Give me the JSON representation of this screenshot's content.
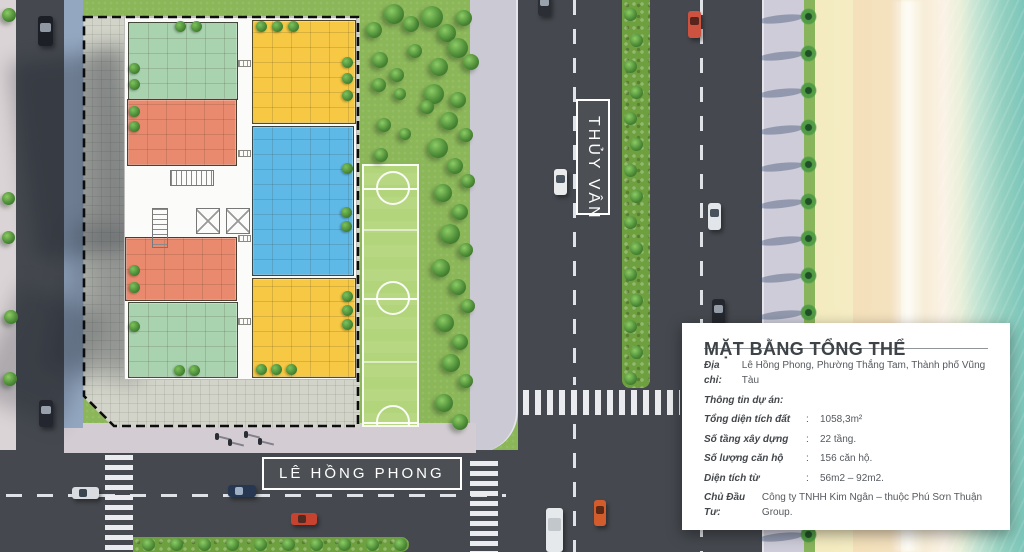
{
  "road_labels": {
    "vertical": "THỦY VÂN",
    "horizontal": "LÊ HỒNG PHONG"
  },
  "info_panel": {
    "title": "MẶT BẰNG TỔNG THỂ",
    "address_label": "Địa chỉ:",
    "address_value": "Lê Hồng Phong, Phường Thắng Tam, Thành phố Vũng Tàu",
    "section_heading": "Thông tin dự án:",
    "colon": ":",
    "rows": [
      {
        "label": "Tổng diện tích đất",
        "value": "1058,3m²"
      },
      {
        "label": "Số tầng xây dựng",
        "value": "22 tầng."
      },
      {
        "label": "Số lượng căn hộ",
        "value": "156 căn hộ."
      },
      {
        "label": "Diện tích từ",
        "value": "56m2 – 92m2."
      }
    ],
    "developer_label": "Chủ Đầu Tư:",
    "developer_value": "Công ty TNHH Kim Ngân – thuộc Phú Sơn Thuận Group."
  },
  "legend_colors": {
    "unit_green": "#a9d2ae",
    "unit_yellow": "#f6c844",
    "unit_orange": "#e98a6e",
    "unit_blue": "#5fb9e6",
    "road": "#45494f",
    "sand": "#f4ebbf",
    "sea": "#7cc6ba"
  },
  "plan": {
    "units": [
      {
        "name": "green-top-left",
        "x": 128,
        "y": 22,
        "w": 110,
        "h": 78,
        "color": "green"
      },
      {
        "name": "yellow-top-right",
        "x": 252,
        "y": 20,
        "w": 104,
        "h": 104,
        "color": "yellow"
      },
      {
        "name": "orange-upper-left",
        "x": 127,
        "y": 99,
        "w": 110,
        "h": 67,
        "color": "orange"
      },
      {
        "name": "blue-right",
        "x": 252,
        "y": 126,
        "w": 102,
        "h": 150,
        "color": "blue"
      },
      {
        "name": "orange-lower-left",
        "x": 125,
        "y": 237,
        "w": 112,
        "h": 64,
        "color": "orange"
      },
      {
        "name": "yellow-bottom-right",
        "x": 252,
        "y": 278,
        "w": 104,
        "h": 100,
        "color": "yellow"
      },
      {
        "name": "green-bottom-left",
        "x": 128,
        "y": 302,
        "w": 110,
        "h": 76,
        "color": "green"
      }
    ],
    "trees": [
      [
        180,
        26
      ],
      [
        196,
        26
      ],
      [
        134,
        68
      ],
      [
        134,
        84
      ],
      [
        261,
        26
      ],
      [
        277,
        26
      ],
      [
        293,
        26
      ],
      [
        347,
        62
      ],
      [
        347,
        78
      ],
      [
        347,
        95
      ],
      [
        134,
        111
      ],
      [
        134,
        126
      ],
      [
        347,
        168
      ],
      [
        346,
        212
      ],
      [
        346,
        226
      ],
      [
        134,
        270
      ],
      [
        134,
        287
      ],
      [
        134,
        326
      ],
      [
        179,
        370
      ],
      [
        194,
        370
      ],
      [
        261,
        369
      ],
      [
        276,
        369
      ],
      [
        291,
        369
      ],
      [
        347,
        296
      ],
      [
        347,
        310
      ],
      [
        347,
        324
      ]
    ],
    "hatches": [
      [
        238,
        60,
        13,
        7
      ],
      [
        238,
        150,
        13,
        7
      ],
      [
        238,
        235,
        13,
        7
      ],
      [
        238,
        318,
        13,
        7
      ]
    ]
  },
  "scenery": {
    "grass_trees": [
      [
        366,
        22,
        16
      ],
      [
        384,
        4,
        20
      ],
      [
        403,
        16,
        16
      ],
      [
        421,
        6,
        22
      ],
      [
        438,
        24,
        18
      ],
      [
        456,
        10,
        16
      ],
      [
        448,
        38,
        20
      ],
      [
        463,
        54,
        16
      ],
      [
        430,
        58,
        18
      ],
      [
        408,
        44,
        14
      ],
      [
        372,
        52,
        16
      ],
      [
        390,
        68,
        14
      ],
      [
        424,
        84,
        20
      ],
      [
        450,
        92,
        16
      ],
      [
        440,
        112,
        18
      ],
      [
        459,
        128,
        14
      ],
      [
        428,
        138,
        20
      ],
      [
        447,
        158,
        16
      ],
      [
        461,
        174,
        14
      ],
      [
        434,
        184,
        18
      ],
      [
        452,
        204,
        16
      ],
      [
        440,
        224,
        20
      ],
      [
        459,
        243,
        14
      ],
      [
        432,
        259,
        18
      ],
      [
        450,
        279,
        16
      ],
      [
        461,
        299,
        14
      ],
      [
        436,
        314,
        18
      ],
      [
        452,
        334,
        16
      ],
      [
        442,
        354,
        18
      ],
      [
        459,
        374,
        14
      ],
      [
        435,
        394,
        18
      ],
      [
        452,
        414,
        16
      ],
      [
        372,
        78,
        14
      ],
      [
        394,
        88,
        12
      ],
      [
        377,
        118,
        14
      ],
      [
        399,
        128,
        12
      ],
      [
        374,
        148,
        14
      ],
      [
        420,
        100,
        14
      ],
      [
        2,
        8,
        14
      ],
      [
        2,
        192,
        13
      ],
      [
        2,
        231,
        13
      ],
      [
        4,
        310,
        14
      ],
      [
        3,
        372,
        14
      ]
    ],
    "cars": [
      {
        "x": 38,
        "y": 16,
        "w": 15,
        "h": 30,
        "body": "#1c1f25",
        "win": "#8f98a3",
        "dir": "v"
      },
      {
        "x": 39,
        "y": 400,
        "w": 14,
        "h": 27,
        "body": "#23262e",
        "win": "#97a0ab",
        "dir": "v"
      },
      {
        "x": 72,
        "y": 487,
        "w": 27,
        "h": 12,
        "body": "#d9dce1",
        "win": "#3a4550",
        "dir": "h"
      },
      {
        "x": 228,
        "y": 485,
        "w": 28,
        "h": 12,
        "body": "#273752",
        "win": "#9fb0c4",
        "dir": "h"
      },
      {
        "x": 291,
        "y": 513,
        "w": 26,
        "h": 12,
        "body": "#c8432f",
        "win": "#4f2b22",
        "dir": "h"
      },
      {
        "x": 554,
        "y": 169,
        "w": 13,
        "h": 26,
        "body": "#e8eaec",
        "win": "#4a545e",
        "dir": "v"
      },
      {
        "x": 538,
        "y": -6,
        "w": 13,
        "h": 22,
        "body": "#2b2e34",
        "win": "#9aa3ad",
        "dir": "v"
      },
      {
        "x": 688,
        "y": 11,
        "w": 13,
        "h": 27,
        "body": "#cd5340",
        "win": "#57251c",
        "dir": "v"
      },
      {
        "x": 708,
        "y": 203,
        "w": 13,
        "h": 27,
        "body": "#e2e5e9",
        "win": "#49525c",
        "dir": "v"
      },
      {
        "x": 712,
        "y": 299,
        "w": 13,
        "h": 26,
        "body": "#24272d",
        "win": "#959ea8",
        "dir": "v"
      },
      {
        "x": 546,
        "y": 508,
        "w": 17,
        "h": 44,
        "body": "#e6e9ec",
        "win": "#c2c7cc",
        "dir": "v"
      },
      {
        "x": 594,
        "y": 500,
        "w": 12,
        "h": 26,
        "body": "#d25c2c",
        "win": "#5c2a14",
        "dir": "v"
      }
    ],
    "palms": {
      "x": 800,
      "y_start": 8,
      "spacing": 37,
      "count": 15
    },
    "pedestrians": [
      [
        215,
        433
      ],
      [
        228,
        439
      ],
      [
        244,
        431
      ],
      [
        258,
        438
      ]
    ],
    "soccer": {
      "x": 362,
      "y": 164,
      "w": 57,
      "h": 263,
      "cx": 391,
      "circle_r": 17,
      "line_ys": [
        186,
        296,
        420
      ],
      "faint_ys": [
        227,
        359
      ]
    }
  }
}
